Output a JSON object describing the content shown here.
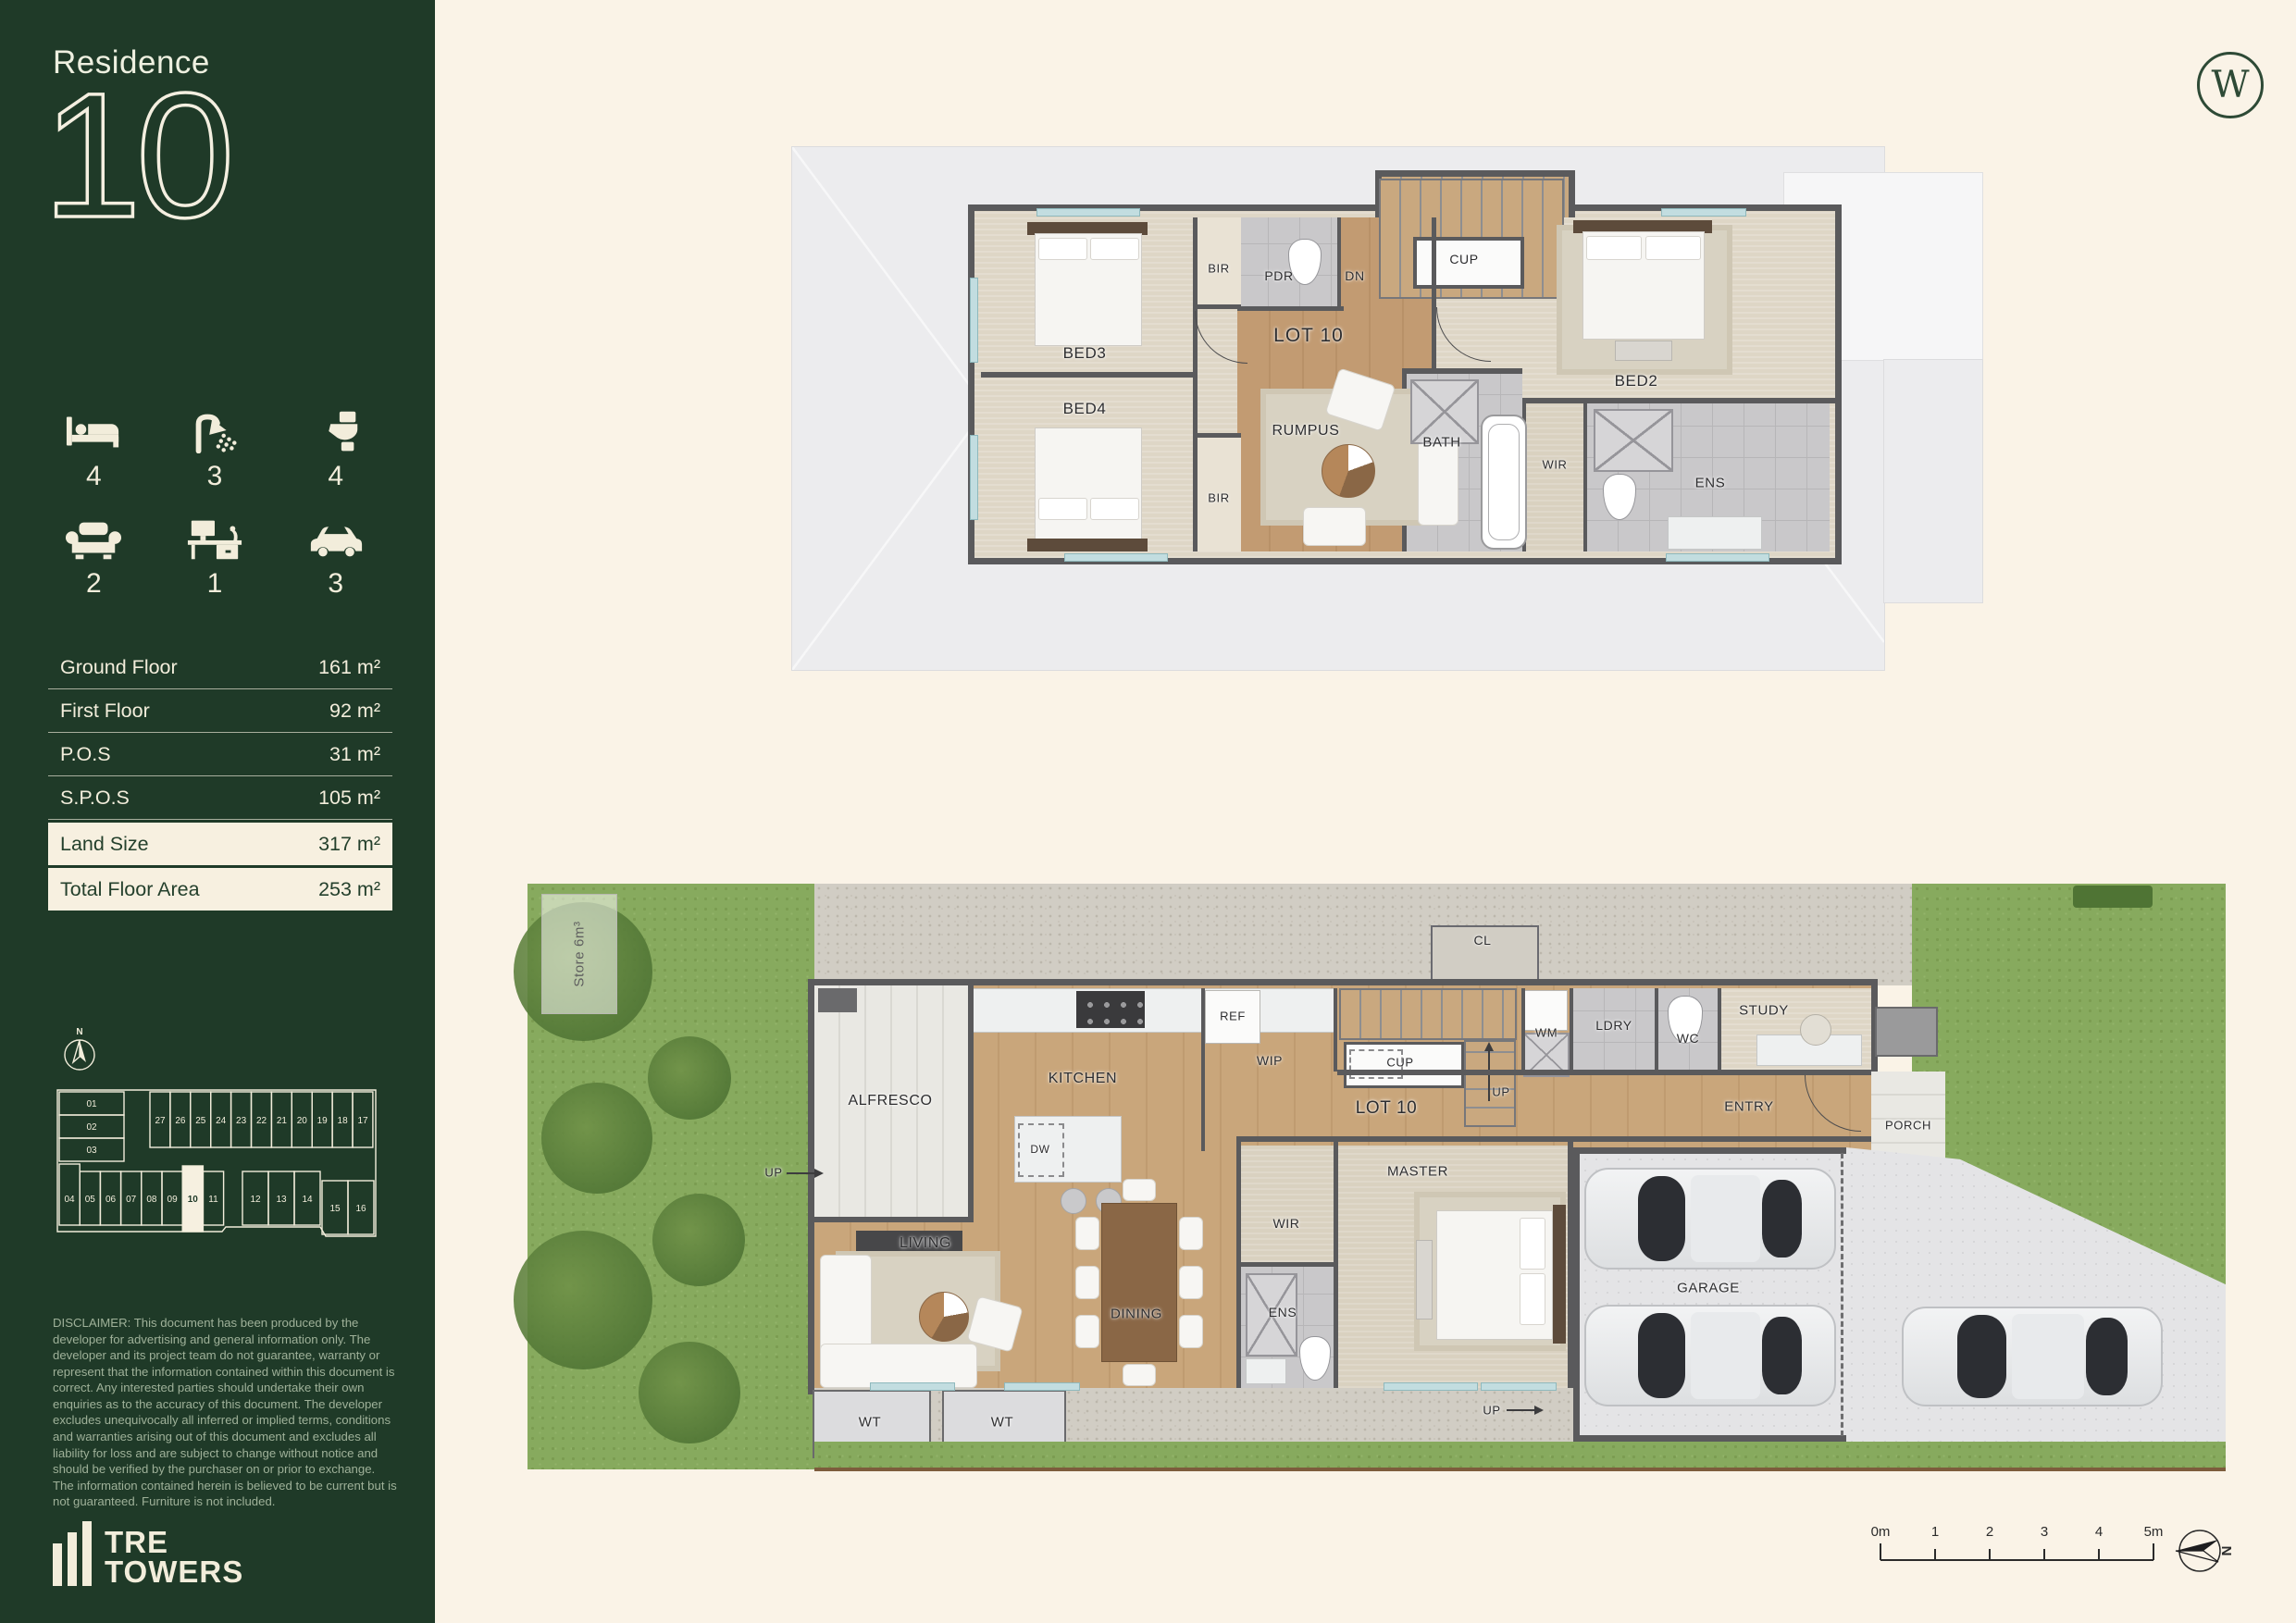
{
  "sidebar": {
    "residence_label": "Residence",
    "residence_number": "10",
    "stats": [
      {
        "name": "bedrooms",
        "count": "4"
      },
      {
        "name": "bathrooms",
        "count": "3"
      },
      {
        "name": "toilets",
        "count": "4"
      },
      {
        "name": "living-areas",
        "count": "2"
      },
      {
        "name": "study",
        "count": "1"
      },
      {
        "name": "car-spaces",
        "count": "3"
      }
    ],
    "areas": [
      {
        "label": "Ground Floor",
        "value": "161 m²"
      },
      {
        "label": "First Floor",
        "value": "92 m²"
      },
      {
        "label": "P.O.S",
        "value": "31 m²"
      },
      {
        "label": "S.P.O.S",
        "value": "105 m²"
      },
      {
        "label": "Land Size",
        "value": "317 m²"
      },
      {
        "label": "Total Floor Area",
        "value": "253 m²"
      }
    ],
    "disclaimer": "DISCLAIMER: This document has been produced by the developer for advertising and general information only. The developer and its project team do not guarantee, warranty or represent that the information contained within this document is correct. Any interested parties should undertake their own enquiries as to the accuracy of this document. The developer excludes unequivocally all inferred or implied terms, conditions and warranties arising out of this document and excludes all liability for loss and are subject to change without notice and should be verified by the purchaser on or prior to exchange. The information contained herein is believed to be current but is not guaranteed. Furniture is not included.",
    "brand_line1": "TRE",
    "brand_line2": "TOWERS"
  },
  "sitemap": {
    "north": "N",
    "lots": {
      "l01": "01",
      "l02": "02",
      "l03": "03",
      "l04": "04",
      "l05": "05",
      "l06": "06",
      "l07": "07",
      "l08": "08",
      "l09": "09",
      "l10": "10",
      "l11": "11",
      "l12": "12",
      "l13": "13",
      "l14": "14",
      "l15": "15",
      "l16": "16",
      "l17": "17",
      "l18": "18",
      "l19": "19",
      "l20": "20",
      "l21": "21",
      "l22": "22",
      "l23": "23",
      "l24": "24",
      "l25": "25",
      "l26": "26",
      "l27": "27"
    }
  },
  "header": {
    "monogram": "W"
  },
  "plans": {
    "first_floor": {
      "labels": {
        "bed3": "BED3",
        "bed4": "BED4",
        "bir_top": "BIR",
        "bir_bottom": "BIR",
        "pdr": "PDR",
        "dn": "DN",
        "cup": "CUP",
        "lot": "LOT 10",
        "rumpus": "RUMPUS",
        "bath": "BATH",
        "wir": "WIR",
        "ens": "ENS",
        "bed2": "BED2"
      }
    },
    "ground_floor": {
      "labels": {
        "store": "Store 6m³",
        "cl": "CL",
        "alfresco": "ALFRESCO",
        "up_alfresco": "UP",
        "kitchen": "KITCHEN",
        "ref": "REF",
        "wip": "WIP",
        "dw": "DW",
        "cup": "CUP",
        "up_stairs": "UP",
        "lot": "LOT 10",
        "wm": "WM",
        "ldry": "LDRY",
        "wc": "WC",
        "study": "STUDY",
        "entry": "ENTRY",
        "porch": "PORCH",
        "living": "LIVING",
        "dining": "DINING",
        "wir": "WIR",
        "ens": "ENS",
        "master": "MASTER",
        "garage": "GARAGE",
        "wt1": "WT",
        "wt2": "WT",
        "up_garage": "UP"
      }
    }
  },
  "scalebar": {
    "ticks": [
      "0m",
      "1",
      "2",
      "3",
      "4",
      "5m"
    ],
    "north": "N"
  }
}
